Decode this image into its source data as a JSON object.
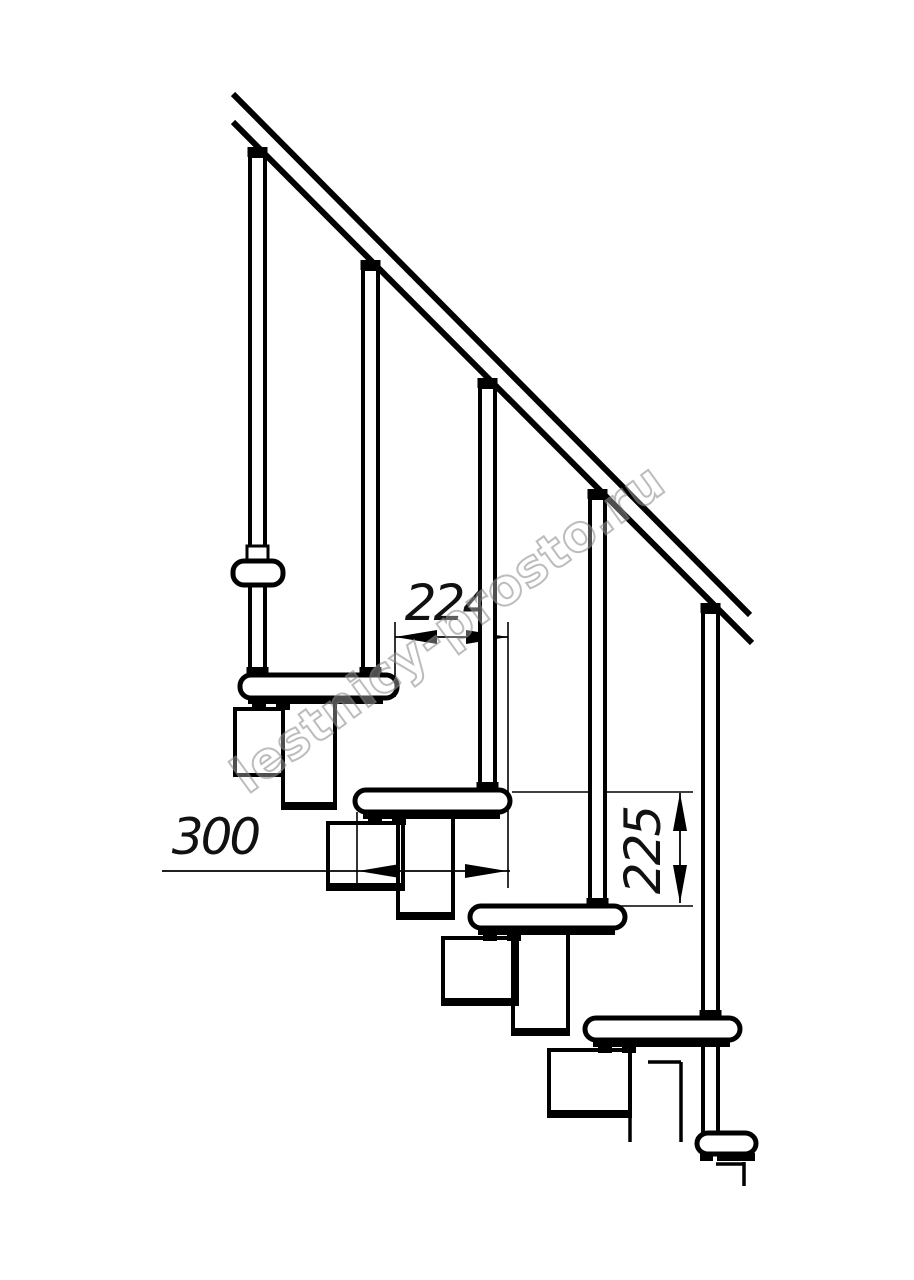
{
  "drawing": {
    "description": "Side-view technical drawing of a modular staircase: handrail, balusters, treads and zigzag support modules",
    "background": "#ffffff",
    "line_color": "#000000",
    "canvas": {
      "width": 914,
      "height": 1280
    }
  },
  "watermark": {
    "text": "lestnicy-prosto.ru",
    "stroke_color": "#949494",
    "fill_color": "#ffffff",
    "fill_opacity": 0.5,
    "opacity": 0.62,
    "angle_deg": -36,
    "cx": 458,
    "cy": 642,
    "font_size": 50,
    "letter_spacing": 1
  },
  "dimensions": [
    {
      "id": "dim-224",
      "label": "224",
      "value": 224,
      "orientation": "horizontal",
      "label_x": 448,
      "label_y": 620,
      "font_size": 50,
      "line": [
        395,
        637,
        508,
        637
      ],
      "arrows": [
        {
          "tip": [
            395,
            637
          ],
          "dir": "left"
        },
        {
          "tip": [
            508,
            637
          ],
          "dir": "right"
        }
      ],
      "extension_lines": [
        [
          395,
          622,
          395,
          697
        ],
        [
          508,
          622,
          508,
          888
        ]
      ]
    },
    {
      "id": "dim-300",
      "label": "300",
      "value": 300,
      "orientation": "horizontal",
      "label_x": 215,
      "label_y": 854,
      "font_size": 50,
      "line": [
        162,
        871,
        510,
        871
      ],
      "arrows": [
        {
          "tip": [
            358,
            871
          ],
          "dir": "left"
        },
        {
          "tip": [
            507,
            871
          ],
          "dir": "right"
        }
      ],
      "extension_lines": [
        [
          357,
          812,
          357,
          888
        ]
      ]
    },
    {
      "id": "dim-225",
      "label": "225",
      "value": 225,
      "orientation": "vertical",
      "label_x": 660,
      "label_y": 851,
      "font_size": 50,
      "label_rotation": -90,
      "line": [
        680,
        793,
        680,
        903
      ],
      "arrows": [
        {
          "tip": [
            680,
            793
          ],
          "dir": "up"
        },
        {
          "tip": [
            680,
            903
          ],
          "dir": "down"
        }
      ],
      "extension_lines": [
        [
          512,
          792,
          693,
          792
        ],
        [
          618,
          906,
          693,
          906
        ]
      ]
    }
  ],
  "handrail": {
    "stroke_width": 6,
    "lines": [
      {
        "id": "handrail-upper-line",
        "x1": 233,
        "y1": 94,
        "x2": 750,
        "y2": 615
      },
      {
        "id": "handrail-lower-line",
        "x1": 233,
        "y1": 122,
        "x2": 752,
        "y2": 643
      }
    ]
  },
  "balusters": {
    "width": 15,
    "stroke_width": 4,
    "posts": [
      {
        "id": "baluster-1",
        "cx": 257.5,
        "top": 156,
        "bottom": 675,
        "cap_y": 147,
        "flare_y": 667,
        "collar": {
          "x": 247,
          "y": 546,
          "w": 21,
          "h": 14
        }
      },
      {
        "id": "baluster-2",
        "cx": 370.5,
        "top": 269,
        "bottom": 675,
        "cap_y": 260,
        "flare_y": 667
      },
      {
        "id": "baluster-3",
        "cx": 487.5,
        "top": 387,
        "bottom": 790,
        "cap_y": 378,
        "flare_y": 782
      },
      {
        "id": "baluster-4",
        "cx": 597.5,
        "top": 498,
        "bottom": 906,
        "cap_y": 489,
        "flare_y": 898
      },
      {
        "id": "baluster-5",
        "cx": 710.5,
        "top": 612,
        "bottom": 1018,
        "cap_y": 603,
        "flare_y": 1010,
        "lower_segment": {
          "top": 1040,
          "bottom": 1133
        }
      }
    ]
  },
  "steps": {
    "stroke_width": 5,
    "corner_radius": 11,
    "treads": [
      {
        "id": "step-end-upper",
        "x": 233,
        "y": 561,
        "w": 50,
        "h": 24,
        "end_view": true
      },
      {
        "id": "step-1",
        "x": 240,
        "y": 675,
        "w": 157,
        "h": 23,
        "end_view": false
      },
      {
        "id": "step-2",
        "x": 355,
        "y": 790,
        "w": 155,
        "h": 22,
        "end_view": false
      },
      {
        "id": "step-3",
        "x": 470,
        "y": 906,
        "w": 155,
        "h": 22,
        "end_view": false
      },
      {
        "id": "step-4",
        "x": 585,
        "y": 1018,
        "w": 155,
        "h": 22,
        "end_view": false
      },
      {
        "id": "step-end-lower",
        "x": 697,
        "y": 1133,
        "w": 59,
        "h": 21,
        "end_view": true
      }
    ]
  },
  "modules": {
    "stroke_width": 4,
    "bottom_bar_height": 8,
    "boxes": [
      {
        "id": "module-end-view",
        "x": 235,
        "y": 709,
        "w": 48,
        "h": 66,
        "bottom_bar": false
      },
      {
        "id": "module-1a",
        "x": 283,
        "y": 702,
        "w": 52,
        "h": 106,
        "bottom_bar": true
      },
      {
        "id": "module-2a",
        "x": 398,
        "y": 815,
        "w": 55,
        "h": 103,
        "bottom_bar": true
      },
      {
        "id": "module-3a",
        "x": 513,
        "y": 929,
        "w": 55,
        "h": 105,
        "bottom_bar": true
      },
      {
        "id": "module-1b",
        "x": 328,
        "y": 823,
        "w": 75,
        "h": 66,
        "bottom_bar": true
      },
      {
        "id": "module-2b",
        "x": 443,
        "y": 938,
        "w": 74,
        "h": 66,
        "bottom_bar": true
      },
      {
        "id": "module-3b",
        "x": 549,
        "y": 1050,
        "w": 81,
        "h": 66,
        "bottom_bar": true
      }
    ]
  },
  "clamps": {
    "bar_height": 7,
    "tab_w": 14,
    "tab_h": 6,
    "items": [
      {
        "id": "clamp-step-1",
        "bar": [
          248,
          697,
          135
        ],
        "tabs": [
          [
            252,
            704
          ],
          [
            276,
            704
          ]
        ]
      },
      {
        "id": "clamp-step-2",
        "bar": [
          363,
          812,
          137
        ],
        "tabs": [
          [
            368,
            819
          ],
          [
            392,
            819
          ]
        ]
      },
      {
        "id": "clamp-step-3",
        "bar": [
          478,
          928,
          137
        ],
        "tabs": [
          [
            483,
            935
          ],
          [
            507,
            935
          ]
        ]
      },
      {
        "id": "clamp-step-4",
        "bar": [
          593,
          1040,
          137
        ],
        "tabs": [
          [
            598,
            1047
          ],
          [
            622,
            1047
          ]
        ]
      }
    ],
    "lower_end_clamps": [
      [
        700,
        1153,
        13,
        8
      ],
      [
        717,
        1153,
        38,
        8
      ]
    ]
  },
  "break_lines": [
    [
      648,
      1062,
      681,
      1062
    ],
    [
      681,
      1062,
      681,
      1142
    ],
    [
      630,
      1116,
      630,
      1142
    ],
    [
      716,
      1164,
      743,
      1164
    ],
    [
      744,
      1162,
      744,
      1186
    ]
  ]
}
